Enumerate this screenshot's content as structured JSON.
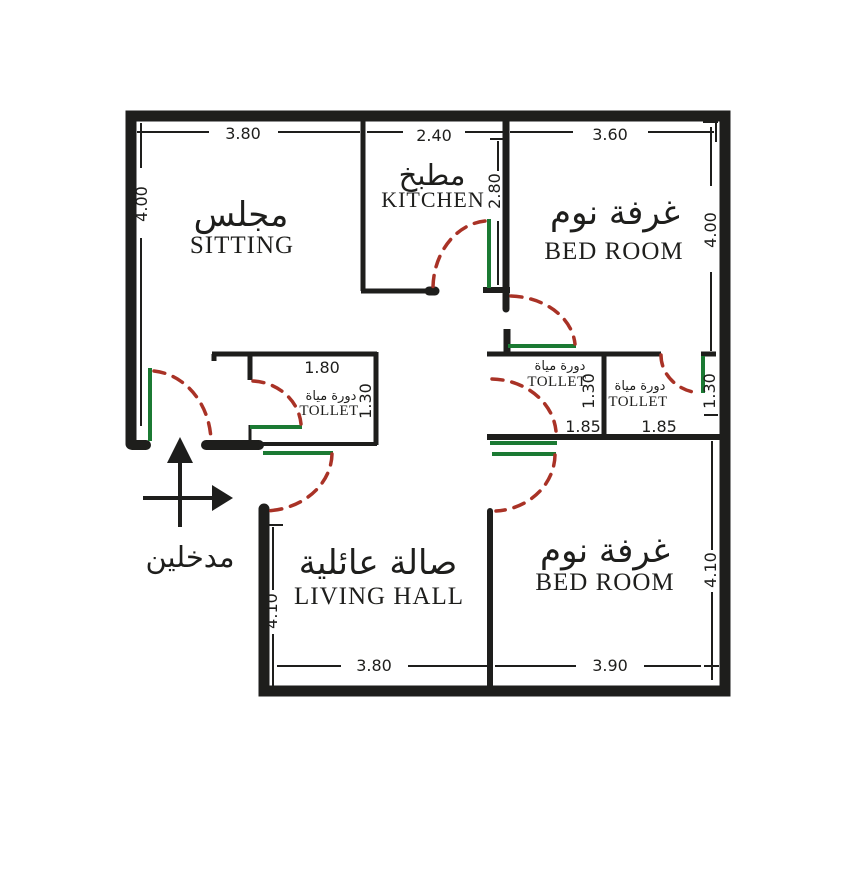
{
  "floor_plan": {
    "rooms": {
      "sitting": {
        "name_ar": "مجلس",
        "name_en": "SITTING"
      },
      "kitchen": {
        "name_ar": "مطبخ",
        "name_en": "KITCHEN"
      },
      "bedroom_top": {
        "name_ar": "غرفة نوم",
        "name_en": "BED ROOM"
      },
      "bedroom_bottom": {
        "name_ar": "غرفة نوم",
        "name_en": "BED ROOM"
      },
      "living_hall": {
        "name_ar": "صالة عائلية",
        "name_en": "LIVING HALL"
      },
      "toilet_left": {
        "name_ar": "دورة مياة",
        "name_en": "TOLLET"
      },
      "toilet_mid": {
        "name_ar": "دورة مياة",
        "name_en": "TOLLET"
      },
      "toilet_right": {
        "name_ar": "دورة مياة",
        "name_en": "TOLLET"
      }
    },
    "entrance_label": "مدخلين",
    "dims": {
      "top_sitting": "3.80",
      "top_kitchen": "2.40",
      "top_bedroom": "3.60",
      "left_sitting": "4.00",
      "kitchen_depth": "2.80",
      "right_bedroom_top": "4.00",
      "toilet_left_w": "1.80",
      "toilet_left_d": "1.30",
      "toilet_mid_d": "1.30",
      "toilet_right_d": "1.30",
      "toilet_mid_w": "1.85",
      "toilet_right_w": "1.85",
      "hall_depth": "4.10",
      "right_bedroom_bottom": "4.10",
      "bottom_hall": "3.80",
      "bottom_bedroom": "3.90"
    },
    "colors": {
      "wall": "#1e1e1c",
      "door_arc": "#a93226",
      "door_leaf": "#1b7a33",
      "dim_text": "#1e1e1c",
      "background": "#ffffff"
    }
  }
}
